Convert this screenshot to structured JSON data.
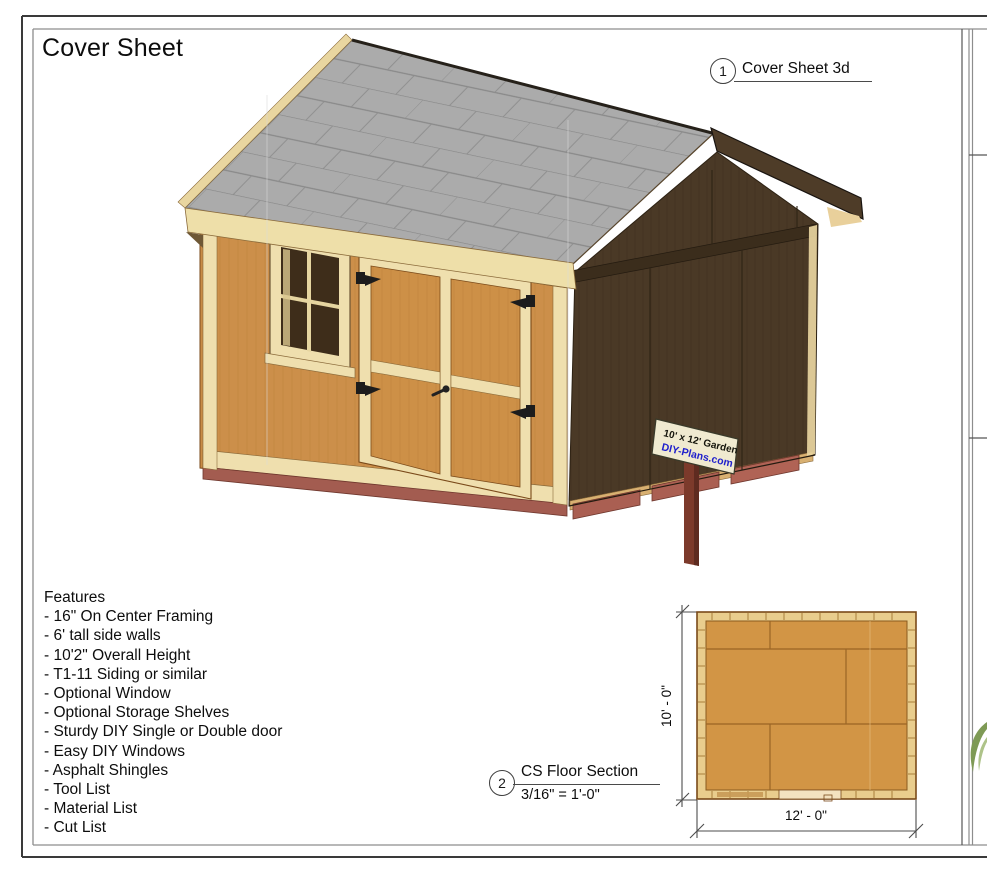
{
  "sheet": {
    "title": "Cover Sheet"
  },
  "callouts": [
    {
      "number": "1",
      "label": "Cover Sheet 3d"
    },
    {
      "number": "2",
      "label": "CS Floor Section",
      "scale": "3/16\" = 1'-0\""
    }
  ],
  "features": {
    "heading": "Features",
    "items": [
      "- 16\" On Center Framing",
      "- 6' tall side walls",
      "- 10'2\" Overall Height",
      "- T1-11 Siding or similar",
      "- Optional Window",
      "- Optional Storage Shelves",
      "- Sturdy DIY Single or Double door",
      "- Easy DIY Windows",
      "- Asphalt Shingles",
      "- Tool List",
      "- Material List",
      "- Cut List"
    ]
  },
  "shed_sign": {
    "line1": "10' x 12' Garden",
    "line2": "DIY-Plans.com"
  },
  "floor_plan": {
    "height_label": "10' - 0\"",
    "width_label": "12' - 0\""
  },
  "colors": {
    "siding": "#cc8f4a",
    "trim_cream": "#f0e0ad",
    "roof_gray": "#ababab",
    "dark_wall": "#4a3926",
    "skid_red": "#a35c50",
    "sign_url_blue": "#2020cc",
    "plywood": "#d29545"
  }
}
